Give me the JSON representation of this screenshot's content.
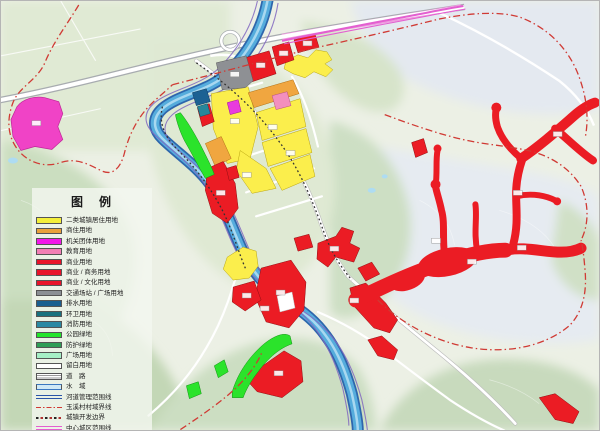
{
  "legend": {
    "title": "图　例",
    "items": [
      {
        "label": "二类城镇居住用地",
        "swatch": "fill",
        "color": "#F4EF3A"
      },
      {
        "label": "商住用地",
        "swatch": "fill",
        "color": "#E9A23C"
      },
      {
        "label": "机关团体用地",
        "swatch": "fill",
        "color": "#F318E9"
      },
      {
        "label": "教育用地",
        "swatch": "fill",
        "color": "#F27FB5"
      },
      {
        "label": "商业用地",
        "swatch": "fill",
        "color": "#E8142B"
      },
      {
        "label": "商业 / 商务用地",
        "swatch": "fill",
        "color": "#E8142B"
      },
      {
        "label": "商业 / 文化用地",
        "swatch": "fill",
        "color": "#E8142B"
      },
      {
        "label": "交通场站 / 广场用地",
        "swatch": "fill",
        "color": "#8A8F94"
      },
      {
        "label": "排水用地",
        "swatch": "fill",
        "color": "#1A5F90"
      },
      {
        "label": "环卫用地",
        "swatch": "fill",
        "color": "#19717F"
      },
      {
        "label": "消防用地",
        "swatch": "fill",
        "color": "#2B89A3"
      },
      {
        "label": "公园绿地",
        "swatch": "fill",
        "color": "#23E52B"
      },
      {
        "label": "防护绿地",
        "swatch": "fill",
        "color": "#2F9E57"
      },
      {
        "label": "广场用地",
        "swatch": "fill",
        "color": "#A6EFC6"
      },
      {
        "label": "留白用地",
        "swatch": "fill",
        "color": "#FFFFFF"
      },
      {
        "label": "道　路",
        "swatch": "stripes"
      },
      {
        "label": "水　域",
        "swatch": "water"
      },
      {
        "label": "河道管理范围线",
        "swatch": "line-river"
      },
      {
        "label": "玉溪村村域界线",
        "swatch": "line-village"
      },
      {
        "label": "城镇开发边界",
        "swatch": "line-dev"
      },
      {
        "label": "中心城区范围线",
        "swatch": "line-center"
      }
    ]
  },
  "map_colors": {
    "background": "#ECF0E5",
    "river": "#55ACDC",
    "river_edge": "#2E66AC",
    "residential_yellow": "#FBEE4C",
    "commercial_red": "#EB1C24",
    "mixed_orange": "#F0A640",
    "government_magenta": "#F043C6",
    "education_pink": "#F38FBE",
    "transport_gray": "#8E9094",
    "utility_blue": "#1C6193",
    "fire_teal": "#27879B",
    "park_green": "#2BE32B",
    "village_boundary_red": "#D03A34",
    "center_district_pink": "#E35FD0",
    "development_boundary": "#333333"
  }
}
